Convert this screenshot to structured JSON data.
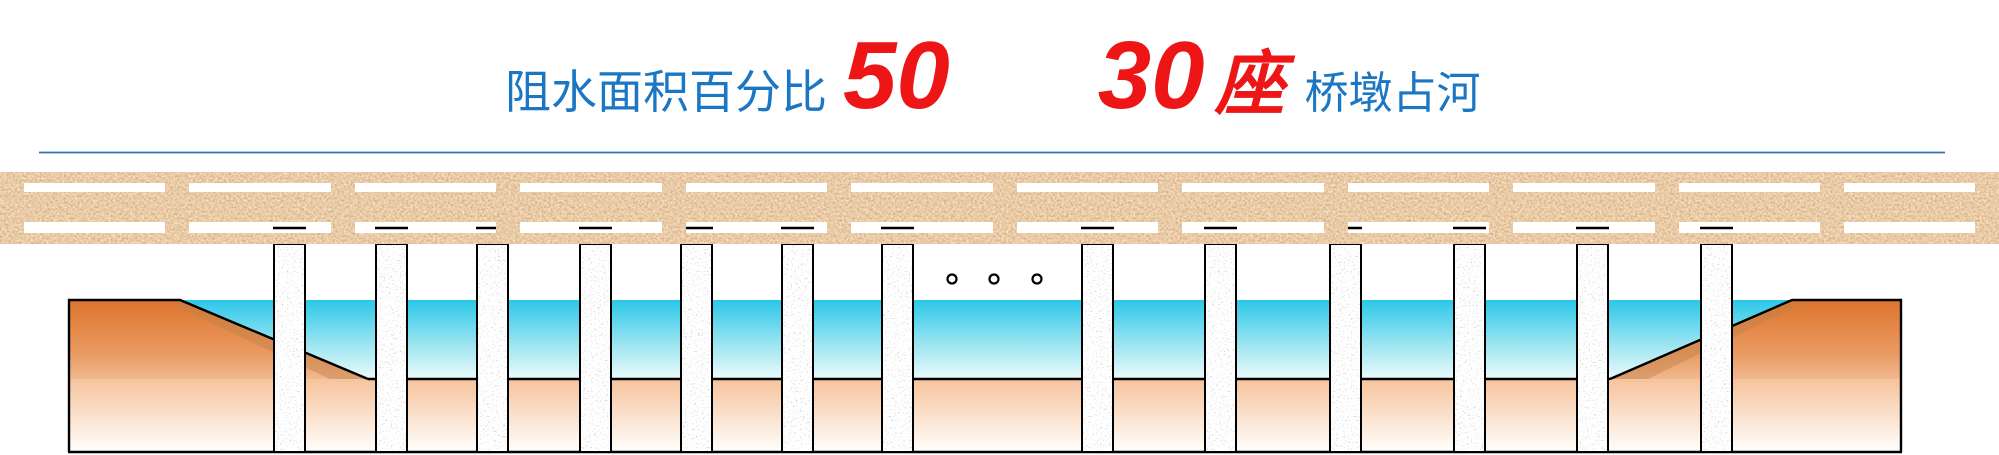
{
  "header": {
    "label_blocking_area": "阻水面积百分比",
    "blocking_percent_value": "50",
    "pier_count_value": "30",
    "pier_count_unit": "座",
    "label_piers_occupy_river": "桥墩占河"
  },
  "colors": {
    "label_blue": "#1B76C4",
    "value_red": "#ED1515",
    "divider_blue": "#2E74B5",
    "water_cyan_top": "#2BC7E8",
    "water_cyan_bottom": "#ECFAFB",
    "bank_orange": "#DE742C",
    "riverbed_peach": "#F6C39C",
    "deck_cork_tan": "#C79462",
    "pier_granite_gray": "#DADADA",
    "outline_black": "#000000"
  },
  "illustration": {
    "visible_pier_count": 13,
    "ellipsis_dot_count": 3,
    "railing_post_count": 13
  }
}
